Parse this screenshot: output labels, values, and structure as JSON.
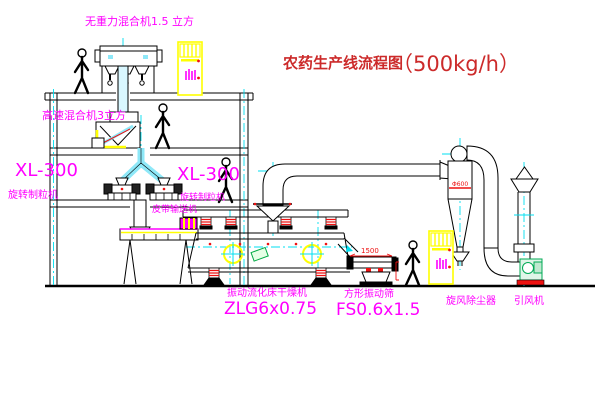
{
  "title": {
    "main": "农药生产线流程图",
    "capacity": "（500kg/h）"
  },
  "labels": {
    "gravity_mixer": "无重力混合机1.5 立方",
    "high_speed_mixer": "高速混合机3立方",
    "granulator_left_model": "XL-300",
    "granulator_left_name": "旋转制粒机",
    "granulator_right_model": "XL-300",
    "granulator_right_name": "旋转制粒机",
    "belt_conveyor": "皮带输送机",
    "dryer_name": "振动流化床干燥机",
    "dryer_model": "ZLG6x0.75",
    "screener_name": "方形振动筛",
    "screener_model": "FS0.6x1.5",
    "cyclone": "旋风除尘器",
    "fan": "引风机"
  },
  "dimensions": {
    "cyclone_diameter": "Φ600",
    "screen_length": "1500"
  },
  "colors": {
    "label_magenta": "#ff00ff",
    "title_red": "#cc2a2a",
    "dimension_red": "#ee1111",
    "highlight_yellow": "#ffff00",
    "centerline_cyan": "#00dff0",
    "line_black": "#000000"
  }
}
